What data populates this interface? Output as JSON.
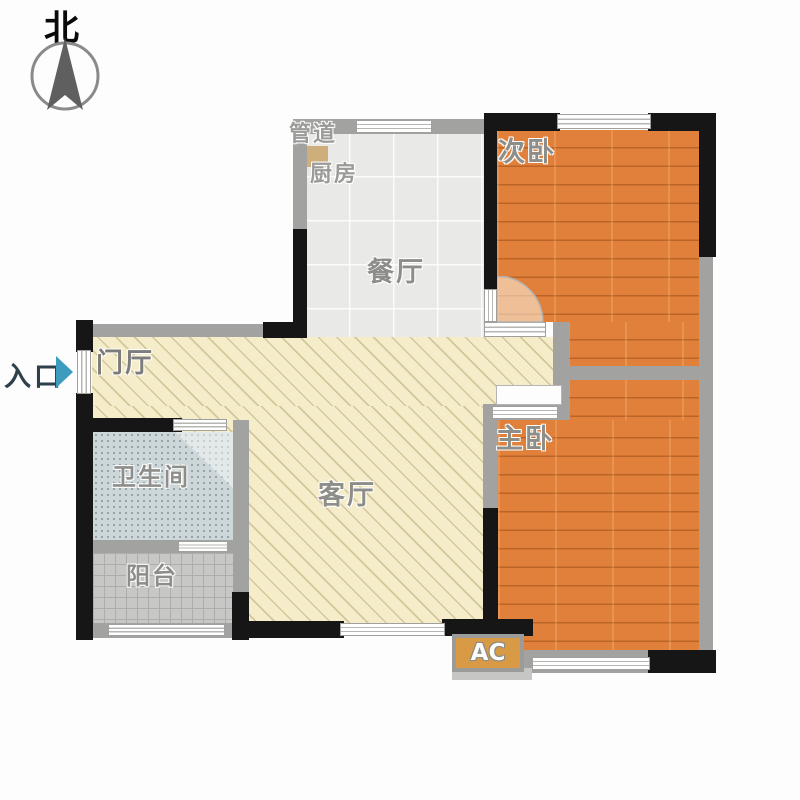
{
  "compass": {
    "label": "北"
  },
  "entrance": {
    "label": "入口"
  },
  "rooms": {
    "duct": "管道",
    "kitchen": "厨房",
    "dining": "餐厅",
    "bedroom2": "次卧",
    "foyer": "门厅",
    "bathroom": "卫生间",
    "living": "客厅",
    "master": "主卧",
    "balcony": "阳台",
    "ac": "AC"
  },
  "palette": {
    "wall_black": "#161616",
    "wall_gray": "#a2a2a0",
    "wood_floor": "#e1803a",
    "tile_floor": "#e9e9e7",
    "hatch_floor": "#f5edca",
    "bath_floor": "#cdd6d8",
    "balcony_floor": "#c7c7c5",
    "entry_arrow": "#3d9cbe",
    "ac_fill": "#d89a44"
  }
}
